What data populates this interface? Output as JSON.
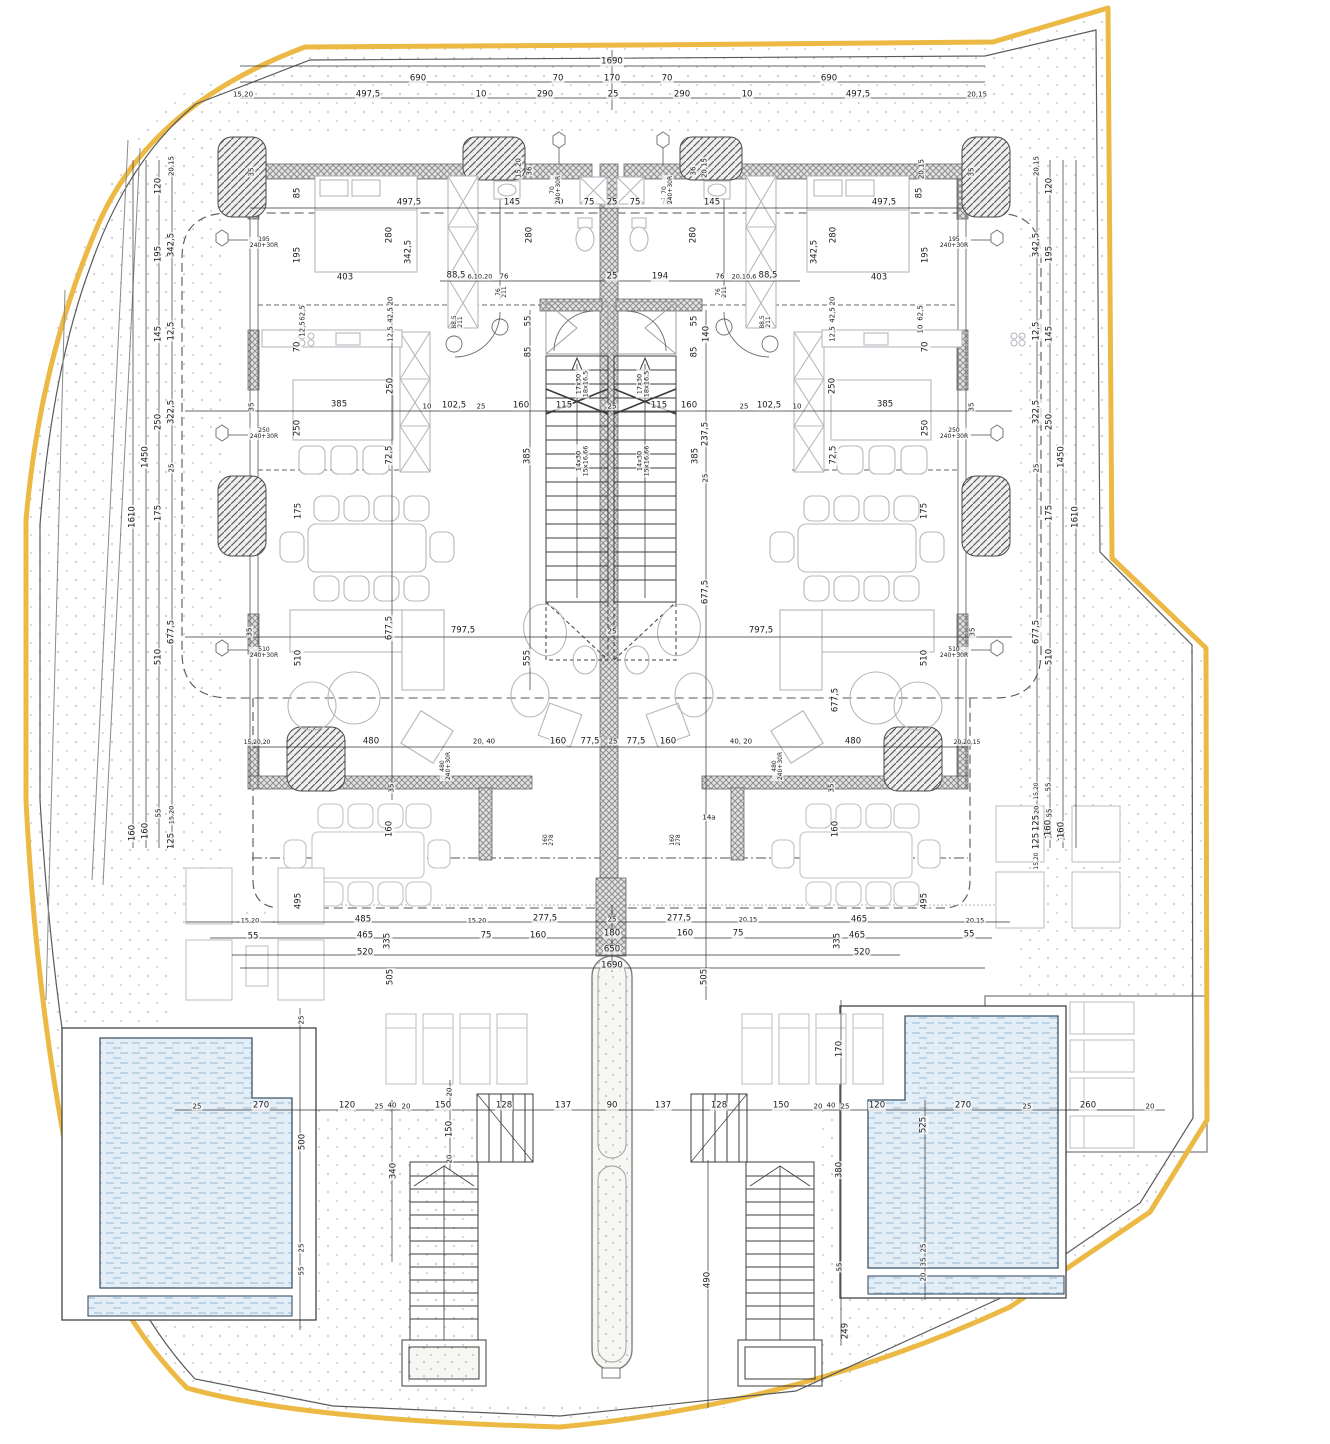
{
  "drawing": {
    "kind": "architectural floor plan (site plan, mirrored duplex villa with pools)",
    "units": "cm",
    "colors": {
      "site_boundary": "#ecb944",
      "inner_boundary": "#555555",
      "wall_hatch": "#8f8f8f",
      "water": "#e4eef7",
      "water_dash": "#a6c4de",
      "dimension_text": "#1a1a1a",
      "furniture": "#b4b8bd"
    }
  },
  "stairs": {
    "upper_flight_label": "17x30 / 18x16,5",
    "lower_flight_label": "14x30 / 15x16,66"
  },
  "labels": [
    {
      "t": "1690",
      "x": 612,
      "y": 62
    },
    {
      "t": "690",
      "x": 418,
      "y": 79
    },
    {
      "t": "70",
      "x": 558,
      "y": 79
    },
    {
      "t": "170",
      "x": 612,
      "y": 79
    },
    {
      "t": "70",
      "x": 667,
      "y": 79
    },
    {
      "t": "690",
      "x": 829,
      "y": 79
    },
    {
      "t": "15,20",
      "x": 243,
      "y": 95,
      "s": 7
    },
    {
      "t": "497,5",
      "x": 368,
      "y": 95
    },
    {
      "t": "10",
      "x": 481,
      "y": 95
    },
    {
      "t": "290",
      "x": 545,
      "y": 95
    },
    {
      "t": "25",
      "x": 613,
      "y": 95
    },
    {
      "t": "290",
      "x": 682,
      "y": 95
    },
    {
      "t": "10",
      "x": 747,
      "y": 95
    },
    {
      "t": "497,5",
      "x": 858,
      "y": 95
    },
    {
      "t": "20,15",
      "x": 977,
      "y": 95,
      "s": 7
    },
    {
      "t": "497,5",
      "x": 409,
      "y": 203
    },
    {
      "t": "497,5",
      "x": 884,
      "y": 203
    },
    {
      "t": "85",
      "x": 298,
      "y": 193,
      "r": 90
    },
    {
      "t": "85",
      "x": 920,
      "y": 193,
      "r": 90
    },
    {
      "t": "280",
      "x": 390,
      "y": 235,
      "r": 90
    },
    {
      "t": "280",
      "x": 834,
      "y": 235,
      "r": 90
    },
    {
      "t": "280",
      "x": 530,
      "y": 235,
      "r": 90
    },
    {
      "t": "280",
      "x": 694,
      "y": 235,
      "r": 90
    },
    {
      "t": "342,5",
      "x": 409,
      "y": 252,
      "r": 90
    },
    {
      "t": "342,5",
      "x": 815,
      "y": 252,
      "r": 90
    },
    {
      "t": "195",
      "x": 298,
      "y": 255,
      "r": 90
    },
    {
      "t": "195",
      "x": 926,
      "y": 255,
      "r": 90
    },
    {
      "t": "403",
      "x": 345,
      "y": 278
    },
    {
      "t": "403",
      "x": 879,
      "y": 278
    },
    {
      "t": "88,5",
      "x": 456,
      "y": 276
    },
    {
      "t": "88,5",
      "x": 768,
      "y": 276
    },
    {
      "t": "6,10,20",
      "x": 480,
      "y": 277,
      "s": 6.5
    },
    {
      "t": "20,10,6",
      "x": 744,
      "y": 277,
      "s": 6.5
    },
    {
      "t": "76",
      "x": 504,
      "y": 277,
      "s": 7
    },
    {
      "t": "76",
      "x": 720,
      "y": 277,
      "s": 7
    },
    {
      "t": "145",
      "x": 512,
      "y": 203
    },
    {
      "t": "145",
      "x": 712,
      "y": 203
    },
    {
      "t": "70",
      "x": 558,
      "y": 203
    },
    {
      "t": "75",
      "x": 589,
      "y": 203
    },
    {
      "t": "25",
      "x": 612,
      "y": 203
    },
    {
      "t": "75",
      "x": 635,
      "y": 203
    },
    {
      "t": "70",
      "x": 666,
      "y": 203
    },
    {
      "t": "194",
      "x": 660,
      "y": 277
    },
    {
      "t": "25",
      "x": 612,
      "y": 277
    },
    {
      "t": "20,15",
      "x": 705,
      "y": 168,
      "r": 90,
      "s": 7
    },
    {
      "t": "15,20",
      "x": 519,
      "y": 168,
      "r": 90,
      "s": 7
    },
    {
      "t": "35",
      "x": 252,
      "y": 172,
      "r": 90,
      "s": 7
    },
    {
      "t": "35",
      "x": 972,
      "y": 172,
      "r": 90,
      "s": 7
    },
    {
      "t": "36",
      "x": 530,
      "y": 171,
      "r": 90,
      "s": 7
    },
    {
      "t": "36",
      "x": 694,
      "y": 171,
      "r": 90,
      "s": 7
    },
    {
      "t": "20,15",
      "x": 922,
      "y": 169,
      "r": 90,
      "s": 7
    },
    {
      "t": "70\n240+30R",
      "x": 556,
      "y": 190,
      "r": 90,
      "s": 6
    },
    {
      "t": "70\n240+30R",
      "x": 668,
      "y": 190,
      "r": 90,
      "s": 6
    },
    {
      "t": "195\n240+30R",
      "x": 264,
      "y": 243,
      "s": 6
    },
    {
      "t": "195\n240+30R",
      "x": 954,
      "y": 243,
      "s": 6
    },
    {
      "t": "76\n211",
      "x": 502,
      "y": 292,
      "r": 90,
      "s": 6
    },
    {
      "t": "76\n211",
      "x": 722,
      "y": 292,
      "r": 90,
      "s": 6
    },
    {
      "t": "88,5\n211",
      "x": 458,
      "y": 322,
      "r": 90,
      "s": 6
    },
    {
      "t": "88,5\n211",
      "x": 766,
      "y": 322,
      "r": 90,
      "s": 6
    },
    {
      "t": "20,15",
      "x": 172,
      "y": 166,
      "r": 90,
      "s": 7
    },
    {
      "t": "120",
      "x": 159,
      "y": 186,
      "r": 90
    },
    {
      "t": "342,5",
      "x": 172,
      "y": 245,
      "r": 90
    },
    {
      "t": "195",
      "x": 159,
      "y": 254,
      "r": 90
    },
    {
      "t": "145",
      "x": 159,
      "y": 334,
      "r": 90
    },
    {
      "t": "12,5",
      "x": 172,
      "y": 331,
      "r": 90
    },
    {
      "t": "322,5",
      "x": 172,
      "y": 412,
      "r": 90
    },
    {
      "t": "250",
      "x": 159,
      "y": 422,
      "r": 90
    },
    {
      "t": "25",
      "x": 172,
      "y": 468,
      "r": 90,
      "s": 7
    },
    {
      "t": "1450",
      "x": 146,
      "y": 457,
      "r": 90
    },
    {
      "t": "1610",
      "x": 133,
      "y": 517,
      "r": 90
    },
    {
      "t": "175",
      "x": 159,
      "y": 513,
      "r": 90
    },
    {
      "t": "677,5",
      "x": 172,
      "y": 632,
      "r": 90
    },
    {
      "t": "510",
      "x": 159,
      "y": 657,
      "r": 90
    },
    {
      "t": "55",
      "x": 159,
      "y": 813,
      "r": 90,
      "s": 7
    },
    {
      "t": "15,20",
      "x": 172,
      "y": 815,
      "r": 90,
      "s": 6.5
    },
    {
      "t": "125",
      "x": 172,
      "y": 841,
      "r": 90
    },
    {
      "t": "160",
      "x": 146,
      "y": 831,
      "r": 90
    },
    {
      "t": "160",
      "x": 133,
      "y": 833,
      "r": 90
    },
    {
      "t": "20,15",
      "x": 1037,
      "y": 166,
      "r": 90,
      "s": 7
    },
    {
      "t": "120",
      "x": 1050,
      "y": 186,
      "r": 90
    },
    {
      "t": "342,5",
      "x": 1037,
      "y": 245,
      "r": 90
    },
    {
      "t": "195",
      "x": 1050,
      "y": 254,
      "r": 90
    },
    {
      "t": "12,5",
      "x": 1037,
      "y": 331,
      "r": 90
    },
    {
      "t": "145",
      "x": 1050,
      "y": 334,
      "r": 90
    },
    {
      "t": "322,5",
      "x": 1037,
      "y": 412,
      "r": 90
    },
    {
      "t": "250",
      "x": 1050,
      "y": 422,
      "r": 90
    },
    {
      "t": "25",
      "x": 1037,
      "y": 468,
      "r": 90,
      "s": 7
    },
    {
      "t": "1450",
      "x": 1062,
      "y": 457,
      "r": 90
    },
    {
      "t": "175",
      "x": 1050,
      "y": 513,
      "r": 90
    },
    {
      "t": "1610",
      "x": 1076,
      "y": 517,
      "r": 90
    },
    {
      "t": "677,5",
      "x": 1037,
      "y": 632,
      "r": 90
    },
    {
      "t": "510",
      "x": 1050,
      "y": 657,
      "r": 90
    },
    {
      "t": "15,20",
      "x": 1037,
      "y": 815,
      "r": 90,
      "s": 6.5
    },
    {
      "t": "55",
      "x": 1050,
      "y": 813,
      "r": 90,
      "s": 7
    },
    {
      "t": "125",
      "x": 1037,
      "y": 841,
      "r": 90
    },
    {
      "t": "160",
      "x": 1050,
      "y": 831,
      "r": 90
    },
    {
      "t": "160",
      "x": 1063,
      "y": 833,
      "r": 90
    },
    {
      "t": "62,5",
      "x": 303,
      "y": 313,
      "r": 90,
      "s": 7
    },
    {
      "t": "12,5",
      "x": 303,
      "y": 329,
      "r": 90,
      "s": 7
    },
    {
      "t": "62,5",
      "x": 921,
      "y": 313,
      "r": 90,
      "s": 7
    },
    {
      "t": "10",
      "x": 921,
      "y": 329,
      "r": 90,
      "s": 7
    },
    {
      "t": "70",
      "x": 298,
      "y": 347,
      "r": 90
    },
    {
      "t": "70",
      "x": 926,
      "y": 347,
      "r": 90
    },
    {
      "t": "20",
      "x": 391,
      "y": 301,
      "r": 90,
      "s": 7
    },
    {
      "t": "42,5",
      "x": 391,
      "y": 315,
      "r": 90,
      "s": 7
    },
    {
      "t": "12,5",
      "x": 391,
      "y": 334,
      "r": 90,
      "s": 7
    },
    {
      "t": "20",
      "x": 833,
      "y": 301,
      "r": 90,
      "s": 7
    },
    {
      "t": "42,5",
      "x": 833,
      "y": 315,
      "r": 90,
      "s": 7
    },
    {
      "t": "12,5",
      "x": 833,
      "y": 334,
      "r": 90,
      "s": 7
    },
    {
      "t": "250",
      "x": 391,
      "y": 386,
      "r": 90
    },
    {
      "t": "250",
      "x": 833,
      "y": 386,
      "r": 90
    },
    {
      "t": "55",
      "x": 529,
      "y": 321,
      "r": 90
    },
    {
      "t": "85",
      "x": 529,
      "y": 352,
      "r": 90
    },
    {
      "t": "55",
      "x": 695,
      "y": 321,
      "r": 90
    },
    {
      "t": "85",
      "x": 695,
      "y": 352,
      "r": 90
    },
    {
      "t": "140",
      "x": 707,
      "y": 334,
      "r": 90
    },
    {
      "t": "35",
      "x": 252,
      "y": 407,
      "r": 90,
      "s": 7
    },
    {
      "t": "385",
      "x": 339,
      "y": 405
    },
    {
      "t": "10",
      "x": 427,
      "y": 407,
      "s": 7
    },
    {
      "t": "102,5",
      "x": 454,
      "y": 406
    },
    {
      "t": "25",
      "x": 481,
      "y": 407,
      "s": 7
    },
    {
      "t": "160",
      "x": 521,
      "y": 406
    },
    {
      "t": "115",
      "x": 564,
      "y": 406
    },
    {
      "t": "25",
      "x": 612,
      "y": 407,
      "s": 7
    },
    {
      "t": "115",
      "x": 659,
      "y": 406
    },
    {
      "t": "160",
      "x": 689,
      "y": 406
    },
    {
      "t": "25",
      "x": 744,
      "y": 407,
      "s": 7
    },
    {
      "t": "102,5",
      "x": 769,
      "y": 406
    },
    {
      "t": "10",
      "x": 797,
      "y": 407,
      "s": 7
    },
    {
      "t": "385",
      "x": 885,
      "y": 405
    },
    {
      "t": "35",
      "x": 972,
      "y": 407,
      "r": 90,
      "s": 7
    },
    {
      "t": "250",
      "x": 298,
      "y": 428,
      "r": 90
    },
    {
      "t": "250",
      "x": 926,
      "y": 428,
      "r": 90
    },
    {
      "t": "250\n240+30R",
      "x": 264,
      "y": 434,
      "s": 6
    },
    {
      "t": "250\n240+30R",
      "x": 954,
      "y": 434,
      "s": 6
    },
    {
      "t": "72,5",
      "x": 390,
      "y": 455,
      "r": 90
    },
    {
      "t": "72,5",
      "x": 834,
      "y": 455,
      "r": 90
    },
    {
      "t": "385",
      "x": 528,
      "y": 456,
      "r": 90
    },
    {
      "t": "385",
      "x": 696,
      "y": 456,
      "r": 90
    },
    {
      "t": "237,5",
      "x": 706,
      "y": 434,
      "r": 90
    },
    {
      "t": "25",
      "x": 706,
      "y": 478,
      "r": 90,
      "s": 7
    },
    {
      "t": "17x30\n18x16,5",
      "x": 582,
      "y": 384,
      "r": 90,
      "s": 6.5
    },
    {
      "t": "17x30\n18x16,5",
      "x": 643,
      "y": 384,
      "r": 90,
      "s": 6.5
    },
    {
      "t": "14x30\n15x16,66",
      "x": 582,
      "y": 461,
      "r": 90,
      "s": 6.5
    },
    {
      "t": "14x30\n15x16,66",
      "x": 643,
      "y": 461,
      "r": 90,
      "s": 6.5
    },
    {
      "t": "175",
      "x": 299,
      "y": 511,
      "r": 90
    },
    {
      "t": "175",
      "x": 925,
      "y": 511,
      "r": 90
    },
    {
      "t": "677,5",
      "x": 390,
      "y": 628,
      "r": 90
    },
    {
      "t": "677,5",
      "x": 706,
      "y": 592,
      "r": 90
    },
    {
      "t": "35",
      "x": 250,
      "y": 632,
      "r": 90,
      "s": 7
    },
    {
      "t": "35",
      "x": 973,
      "y": 632,
      "r": 90,
      "s": 7
    },
    {
      "t": "510\n240+30R",
      "x": 264,
      "y": 653,
      "s": 6
    },
    {
      "t": "510\n240+30R",
      "x": 954,
      "y": 653,
      "s": 6
    },
    {
      "t": "510",
      "x": 299,
      "y": 658,
      "r": 90
    },
    {
      "t": "510",
      "x": 925,
      "y": 658,
      "r": 90
    },
    {
      "t": "797,5",
      "x": 463,
      "y": 631
    },
    {
      "t": "25",
      "x": 612,
      "y": 632,
      "s": 7
    },
    {
      "t": "797,5",
      "x": 761,
      "y": 631
    },
    {
      "t": "555",
      "x": 528,
      "y": 658,
      "r": 90
    },
    {
      "t": "677,5",
      "x": 836,
      "y": 700,
      "r": 90
    },
    {
      "t": "15,20,20",
      "x": 257,
      "y": 743,
      "s": 6
    },
    {
      "t": "480",
      "x": 371,
      "y": 742
    },
    {
      "t": "20, 40",
      "x": 484,
      "y": 742,
      "s": 7
    },
    {
      "t": "160",
      "x": 558,
      "y": 742
    },
    {
      "t": "77,5",
      "x": 590,
      "y": 742
    },
    {
      "t": "25",
      "x": 613,
      "y": 742,
      "s": 7
    },
    {
      "t": "77,5",
      "x": 636,
      "y": 742
    },
    {
      "t": "160",
      "x": 668,
      "y": 742
    },
    {
      "t": "40, 20",
      "x": 741,
      "y": 742,
      "s": 7
    },
    {
      "t": "480",
      "x": 853,
      "y": 742
    },
    {
      "t": "20,20,15",
      "x": 967,
      "y": 743,
      "s": 6
    },
    {
      "t": "480\n240+30R",
      "x": 446,
      "y": 766,
      "r": 90,
      "s": 6
    },
    {
      "t": "480\n240+30R",
      "x": 778,
      "y": 766,
      "r": 90,
      "s": 6
    },
    {
      "t": "35",
      "x": 392,
      "y": 788,
      "r": 90,
      "s": 7
    },
    {
      "t": "35",
      "x": 832,
      "y": 788,
      "r": 90,
      "s": 7
    },
    {
      "t": "160",
      "x": 390,
      "y": 829,
      "r": 90
    },
    {
      "t": "160",
      "x": 836,
      "y": 829,
      "r": 90
    },
    {
      "t": "160\n278",
      "x": 549,
      "y": 840,
      "r": 90,
      "s": 6
    },
    {
      "t": "160\n278",
      "x": 676,
      "y": 840,
      "r": 90,
      "s": 6
    },
    {
      "t": "14a",
      "x": 709,
      "y": 818,
      "s": 7
    },
    {
      "t": "495",
      "x": 299,
      "y": 901,
      "r": 90
    },
    {
      "t": "495",
      "x": 925,
      "y": 901,
      "r": 90
    },
    {
      "t": "15,20",
      "x": 1037,
      "y": 791,
      "r": 90,
      "s": 6
    },
    {
      "t": "55",
      "x": 1049,
      "y": 787,
      "r": 90,
      "s": 7
    },
    {
      "t": "125",
      "x": 1037,
      "y": 823,
      "r": 90
    },
    {
      "t": "160",
      "x": 1049,
      "y": 828,
      "r": 90
    },
    {
      "t": "160",
      "x": 1062,
      "y": 830,
      "r": 90
    },
    {
      "t": "15,20",
      "x": 1037,
      "y": 861,
      "r": 90,
      "s": 6
    },
    {
      "t": "15,20",
      "x": 250,
      "y": 921,
      "s": 6.5
    },
    {
      "t": "485",
      "x": 363,
      "y": 920
    },
    {
      "t": "15,20",
      "x": 477,
      "y": 921,
      "s": 6.5
    },
    {
      "t": "277,5",
      "x": 545,
      "y": 919
    },
    {
      "t": "25",
      "x": 612,
      "y": 920,
      "s": 7
    },
    {
      "t": "277,5",
      "x": 679,
      "y": 919
    },
    {
      "t": "20,15",
      "x": 748,
      "y": 920,
      "s": 6.5
    },
    {
      "t": "465",
      "x": 859,
      "y": 920
    },
    {
      "t": "20,15",
      "x": 975,
      "y": 921,
      "s": 6.5
    },
    {
      "t": "55",
      "x": 253,
      "y": 937
    },
    {
      "t": "465",
      "x": 365,
      "y": 936
    },
    {
      "t": "75",
      "x": 486,
      "y": 936
    },
    {
      "t": "160",
      "x": 538,
      "y": 936
    },
    {
      "t": "180",
      "x": 612,
      "y": 934
    },
    {
      "t": "160",
      "x": 685,
      "y": 934
    },
    {
      "t": "75",
      "x": 738,
      "y": 934
    },
    {
      "t": "465",
      "x": 857,
      "y": 936
    },
    {
      "t": "55",
      "x": 969,
      "y": 935
    },
    {
      "t": "335",
      "x": 388,
      "y": 941,
      "r": 90
    },
    {
      "t": "335",
      "x": 838,
      "y": 941,
      "r": 90
    },
    {
      "t": "520",
      "x": 365,
      "y": 953
    },
    {
      "t": "650",
      "x": 612,
      "y": 950
    },
    {
      "t": "520",
      "x": 862,
      "y": 953
    },
    {
      "t": "1690",
      "x": 612,
      "y": 966
    },
    {
      "t": "505",
      "x": 391,
      "y": 977,
      "r": 90
    },
    {
      "t": "505",
      "x": 705,
      "y": 977,
      "r": 90
    },
    {
      "t": "25",
      "x": 197,
      "y": 1107,
      "s": 7
    },
    {
      "t": "270",
      "x": 261,
      "y": 1106
    },
    {
      "t": "120",
      "x": 347,
      "y": 1106
    },
    {
      "t": "25",
      "x": 379,
      "y": 1107,
      "s": 7
    },
    {
      "t": "40",
      "x": 392,
      "y": 1106,
      "s": 7
    },
    {
      "t": "20",
      "x": 406,
      "y": 1107,
      "s": 7
    },
    {
      "t": "150",
      "x": 443,
      "y": 1106
    },
    {
      "t": "128",
      "x": 504,
      "y": 1106
    },
    {
      "t": "137",
      "x": 563,
      "y": 1106
    },
    {
      "t": "90",
      "x": 612,
      "y": 1106
    },
    {
      "t": "137",
      "x": 663,
      "y": 1106
    },
    {
      "t": "128",
      "x": 719,
      "y": 1106
    },
    {
      "t": "150",
      "x": 781,
      "y": 1106
    },
    {
      "t": "20",
      "x": 818,
      "y": 1107,
      "s": 7
    },
    {
      "t": "40",
      "x": 831,
      "y": 1106,
      "s": 7
    },
    {
      "t": "25",
      "x": 845,
      "y": 1107,
      "s": 7
    },
    {
      "t": "120",
      "x": 877,
      "y": 1106
    },
    {
      "t": "270",
      "x": 963,
      "y": 1106
    },
    {
      "t": "25",
      "x": 1027,
      "y": 1107,
      "s": 7
    },
    {
      "t": "260",
      "x": 1088,
      "y": 1106
    },
    {
      "t": "20",
      "x": 1150,
      "y": 1107,
      "s": 7
    },
    {
      "t": "25",
      "x": 302,
      "y": 1020,
      "r": 90,
      "s": 7
    },
    {
      "t": "500",
      "x": 303,
      "y": 1142,
      "r": 90
    },
    {
      "t": "340",
      "x": 394,
      "y": 1171,
      "r": 90
    },
    {
      "t": "25",
      "x": 302,
      "y": 1248,
      "r": 90,
      "s": 7
    },
    {
      "t": "55",
      "x": 302,
      "y": 1271,
      "r": 90,
      "s": 7
    },
    {
      "t": "20",
      "x": 450,
      "y": 1092,
      "r": 90,
      "s": 7
    },
    {
      "t": "150",
      "x": 450,
      "y": 1129,
      "r": 90
    },
    {
      "t": "20",
      "x": 450,
      "y": 1159,
      "r": 90,
      "s": 7
    },
    {
      "t": "490",
      "x": 708,
      "y": 1280,
      "r": 90
    },
    {
      "t": "170",
      "x": 840,
      "y": 1049,
      "r": 90
    },
    {
      "t": "380",
      "x": 840,
      "y": 1170,
      "r": 90
    },
    {
      "t": "55",
      "x": 840,
      "y": 1267,
      "r": 90,
      "s": 7
    },
    {
      "t": "249",
      "x": 846,
      "y": 1331,
      "r": 90
    },
    {
      "t": "525",
      "x": 924,
      "y": 1125,
      "r": 90
    },
    {
      "t": "25",
      "x": 924,
      "y": 1248,
      "r": 90,
      "s": 7
    },
    {
      "t": "35",
      "x": 924,
      "y": 1262,
      "r": 90,
      "s": 7
    },
    {
      "t": "20",
      "x": 924,
      "y": 1277,
      "r": 90,
      "s": 7
    }
  ]
}
